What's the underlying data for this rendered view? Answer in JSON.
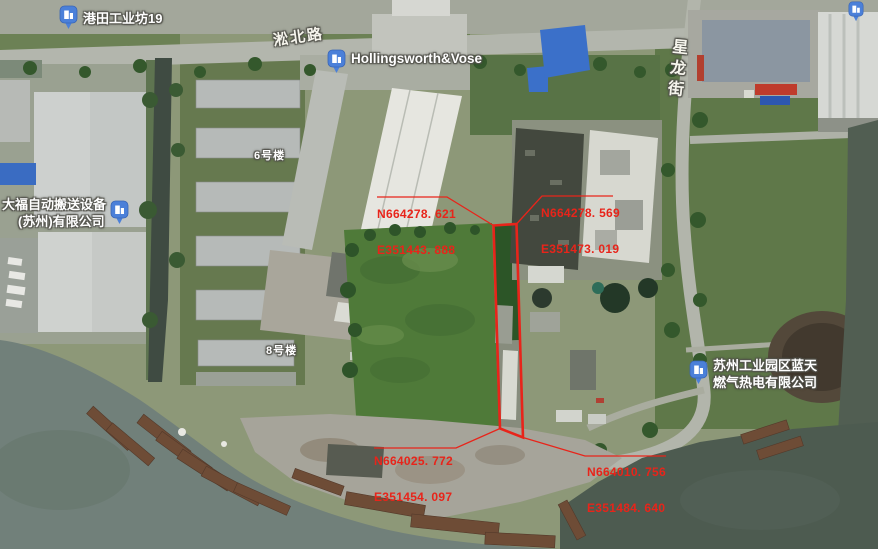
{
  "map": {
    "road_labels": [
      {
        "id": "songbei",
        "text": "淞北路"
      },
      {
        "id": "xinglong",
        "text": "星龙街"
      }
    ],
    "pois": [
      {
        "id": "gangtian",
        "label": "港田工业坊19"
      },
      {
        "id": "hollingsworth",
        "label": "Hollingsworth&Vose"
      },
      {
        "id": "dafu",
        "label_line1": "大福自动搬送设备",
        "label_line2": "(苏州)有限公司"
      },
      {
        "id": "lantian",
        "label_line1": "苏州工业园区蓝天",
        "label_line2": "燃气热电有限公司"
      }
    ],
    "building_labels": [
      {
        "text": "6号楼"
      },
      {
        "text": "8号楼"
      }
    ],
    "survey_annotations": [
      {
        "northing": "N664278. 621",
        "easting": "E351443. 888"
      },
      {
        "northing": "N664278. 569",
        "easting": "E351473. 019"
      },
      {
        "northing": "N664025. 772",
        "easting": "E351454. 097"
      },
      {
        "northing": "N664010. 756",
        "easting": "E351484. 640"
      }
    ],
    "colors": {
      "annotation_red": "#e8241a",
      "poi_blue": "#4b80d9",
      "water_dark": "#4d5b50",
      "water_light": "#71807a"
    }
  }
}
